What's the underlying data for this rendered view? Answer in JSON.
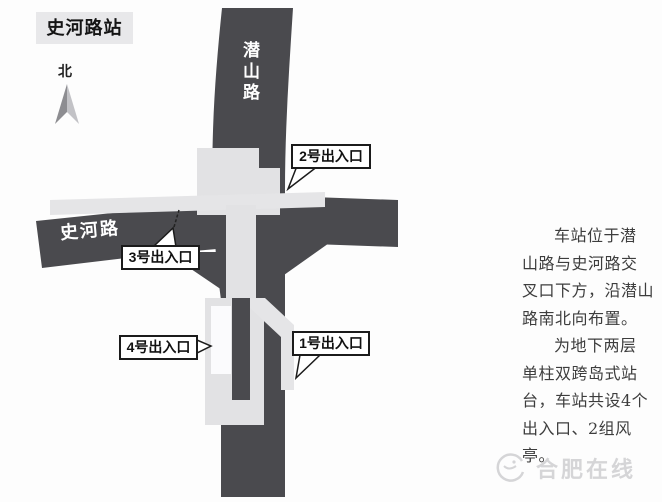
{
  "title": "史河路站",
  "compass": {
    "label": "北",
    "icon": "north-arrow-icon"
  },
  "roads": {
    "vertical_name": "潜山路",
    "horizontal_name": "史河路"
  },
  "exits": [
    {
      "label": "1号出入口"
    },
    {
      "label": "2号出入口"
    },
    {
      "label": "3号出入口"
    },
    {
      "label": "4号出入口"
    }
  ],
  "description": {
    "lines": [
      "车站位于潜",
      "山路与史河路交",
      "叉口下方，沿潜山",
      "路南北向布置。",
      "为地下两层",
      "单柱双跨岛式站",
      "台，车站共设4个",
      "出入口、2组风亭。"
    ]
  },
  "watermark": {
    "text": "合肥在线",
    "icon": "swirl-logo-icon"
  },
  "colors": {
    "road": "#4a4a4e",
    "station": "#e2e2e4",
    "station_arm": "#e5e5e7",
    "exit_passage_white": "#fbfbfd",
    "title_bg": "#e8e8ea",
    "arrow_left": "#8d8d91",
    "arrow_right": "#c2c2c6",
    "description_text": "#3d3d3d",
    "watermark_gray": "#d5d5d7"
  }
}
